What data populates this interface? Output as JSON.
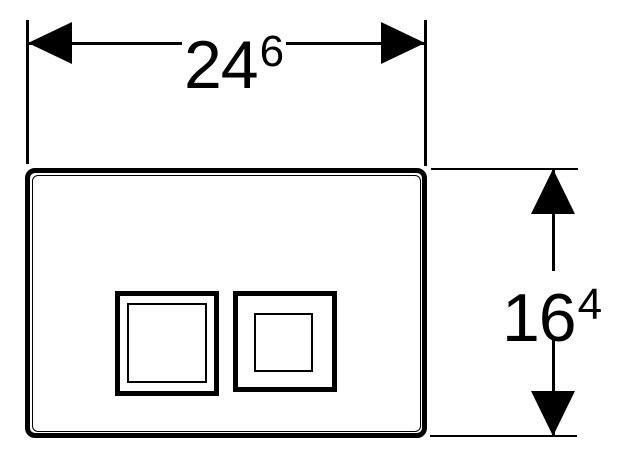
{
  "colors": {
    "line": "#000000",
    "background": "#ffffff"
  },
  "dimensions": {
    "width": {
      "value": "24",
      "superscript": "6"
    },
    "height": {
      "value": "16",
      "superscript": "4"
    }
  }
}
